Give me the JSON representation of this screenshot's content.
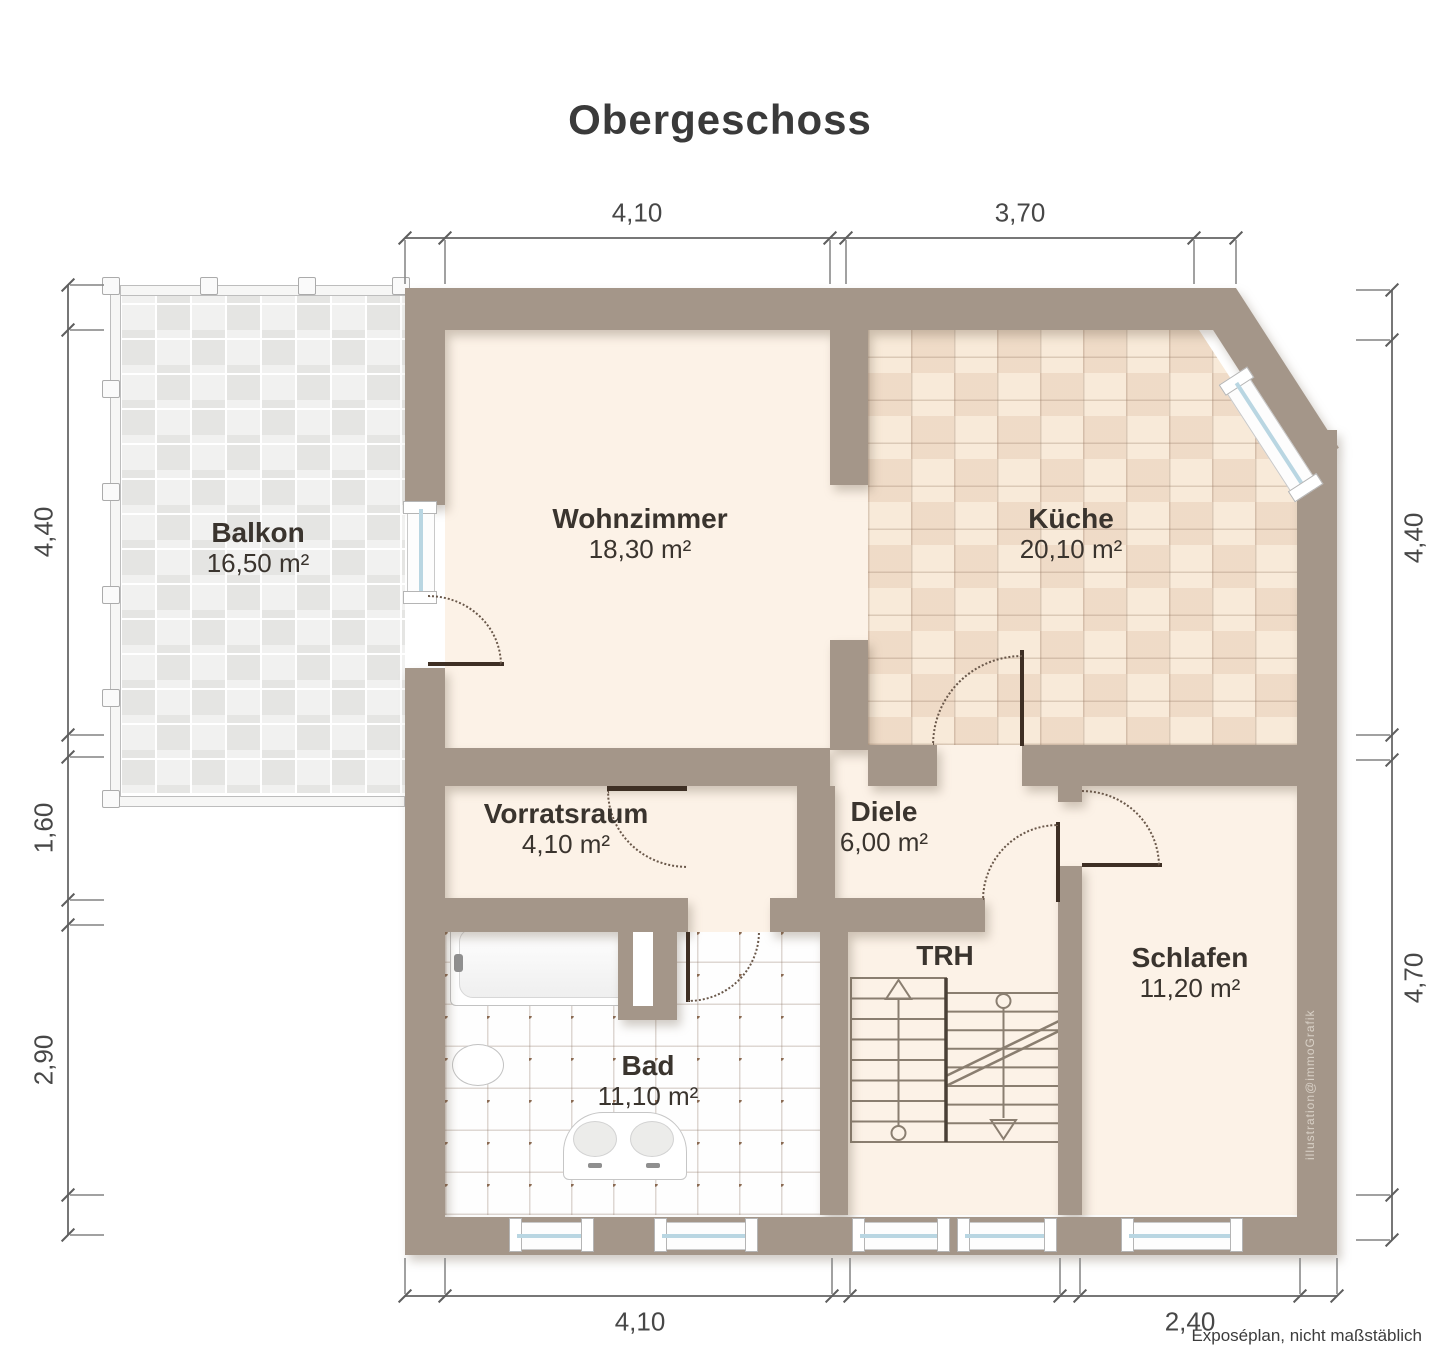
{
  "title": "Obergeschoss",
  "caption": "Exposéplan, nicht maßstäblich",
  "watermark": "illustration@immoGrafik",
  "rooms": [
    {
      "name": "Balkon",
      "area": "16,50 m²"
    },
    {
      "name": "Wohnzimmer",
      "area": "18,30 m²"
    },
    {
      "name": "Küche",
      "area": "20,10 m²"
    },
    {
      "name": "Vorratsraum",
      "area": "4,10 m²"
    },
    {
      "name": "Diele",
      "area": "6,00 m²"
    },
    {
      "name": "TRH",
      "area": ""
    },
    {
      "name": "Schlafen",
      "area": "11,20 m²"
    },
    {
      "name": "Bad",
      "area": "11,10 m²"
    }
  ],
  "dimensions": {
    "top": [
      "4,10",
      "3,70"
    ],
    "bottom": [
      "4,10",
      "2,40"
    ],
    "left": [
      "4,40",
      "1,60",
      "2,90"
    ],
    "right": [
      "4,40",
      "4,70"
    ]
  },
  "colors": {
    "wall": "#a49689",
    "floor": "#fcf2e7",
    "kitchen_tile": "#f8ead9",
    "bath_tile": "#fefefe",
    "balcony_tile": "#f1f1f0",
    "window_glass": "#b9d6e2",
    "door": "#3e2f24",
    "text": "#3a342e"
  }
}
